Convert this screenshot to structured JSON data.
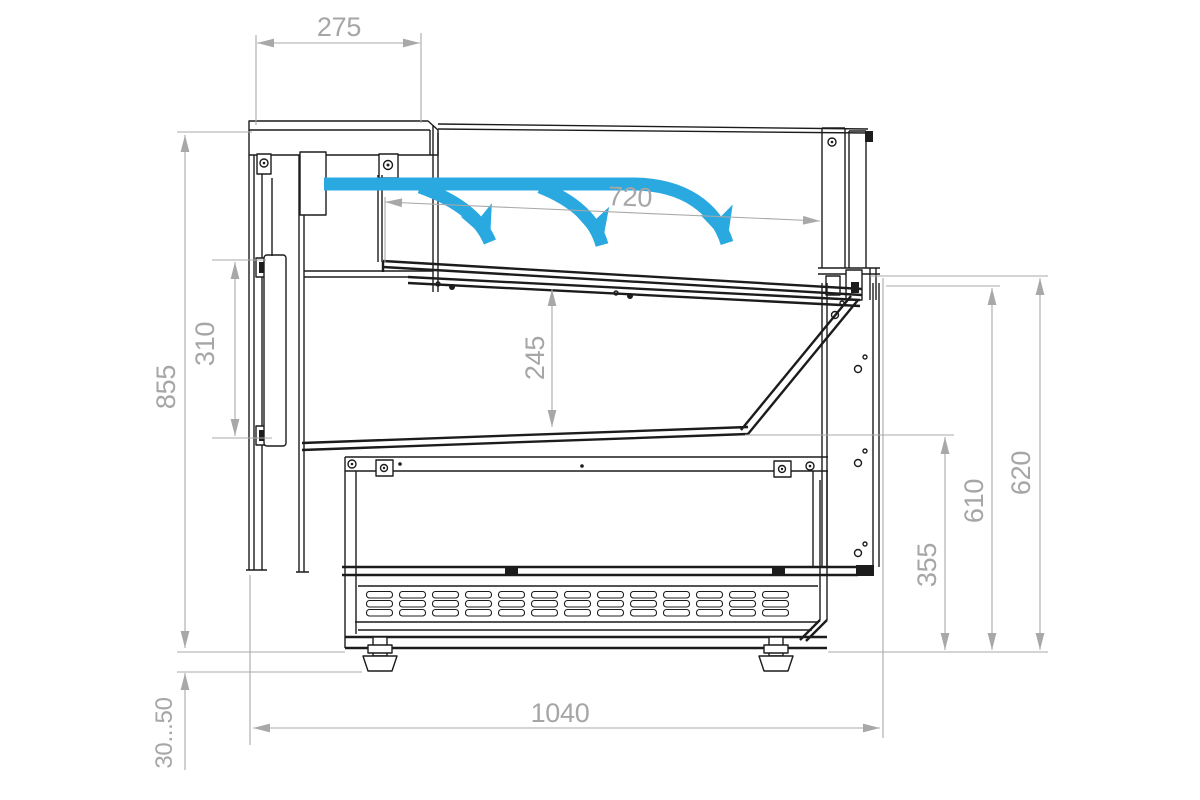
{
  "drawing": {
    "colors": {
      "line": "#1c1c1c",
      "dimension": "#a8a8a8",
      "airflow": "#2aa9e0",
      "background": "#ffffff"
    },
    "airflow": {
      "arrow_count": 3
    },
    "dimensions": {
      "canopy_depth": "275",
      "display_opening_depth": "720",
      "rear_panel_height": "310",
      "body_height": "855",
      "well_depth": "245",
      "base_front_height": "355",
      "deck_to_floor_height": "610",
      "front_height": "620",
      "overall_depth": "1040",
      "foot_adjust_range": "30...50"
    }
  }
}
